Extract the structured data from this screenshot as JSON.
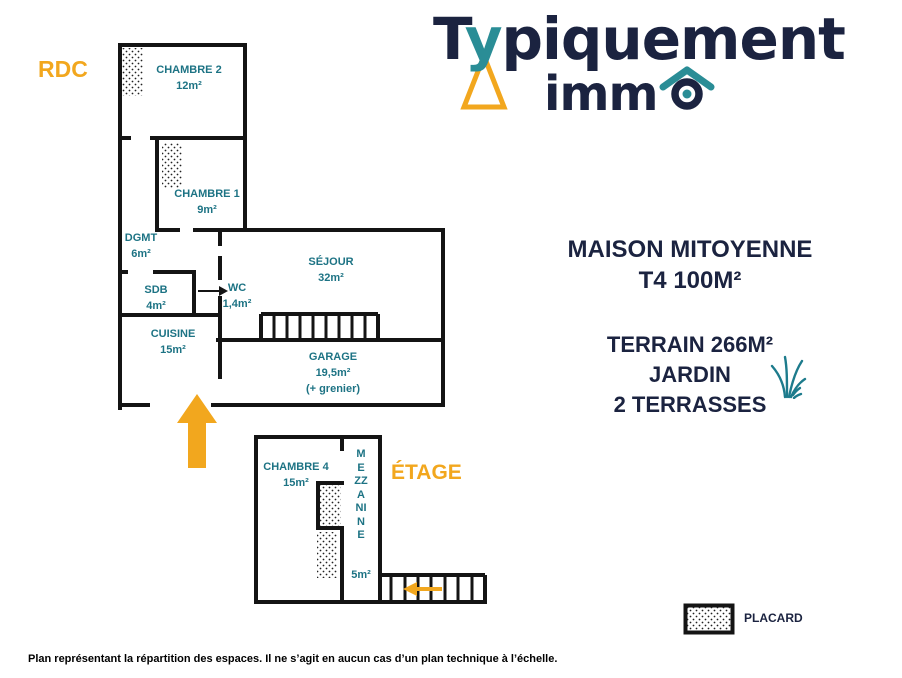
{
  "logo": {
    "t": "T",
    "y": "y",
    "rest": "piquement",
    "immo_prefix": "imm"
  },
  "colors": {
    "navy": "#1b2340",
    "teal": "#1d7384",
    "orange": "#f2a71e",
    "wall": "#141414"
  },
  "floors": {
    "rdc": {
      "label": "RDC",
      "rooms": {
        "chambre2": {
          "name": "CHAMBRE 2",
          "area": "12m²"
        },
        "chambre1": {
          "name": "CHAMBRE 1",
          "area": "9m²"
        },
        "dgmt": {
          "name": "DGMT",
          "area": "6m²"
        },
        "sdb": {
          "name": "SDB",
          "area": "4m²"
        },
        "wc": {
          "name": "WC",
          "area": "1,4m²"
        },
        "sejour": {
          "name": "SÉJOUR",
          "area": "32m²"
        },
        "cuisine": {
          "name": "CUISINE",
          "area": "15m²"
        },
        "garage": {
          "name": "GARAGE",
          "area": "19,5m²",
          "note": "(+ grenier)"
        }
      }
    },
    "etage": {
      "label": "ÉTAGE",
      "rooms": {
        "chambre4": {
          "name": "CHAMBRE 4",
          "area": "15m²"
        },
        "mezzanine": {
          "name": "MEZZANINE",
          "area": "5m²"
        }
      }
    }
  },
  "property": {
    "title_line1": "MAISON MITOYENNE",
    "title_line2": "T4 100M²",
    "features": [
      "TERRAIN 266M²",
      "JARDIN",
      "2 TERRASSES"
    ]
  },
  "legend": {
    "placard": "PLACARD"
  },
  "disclaimer": "Plan représentant la répartition des espaces. Il ne s’agit en aucun cas d’un plan technique à l’échelle."
}
